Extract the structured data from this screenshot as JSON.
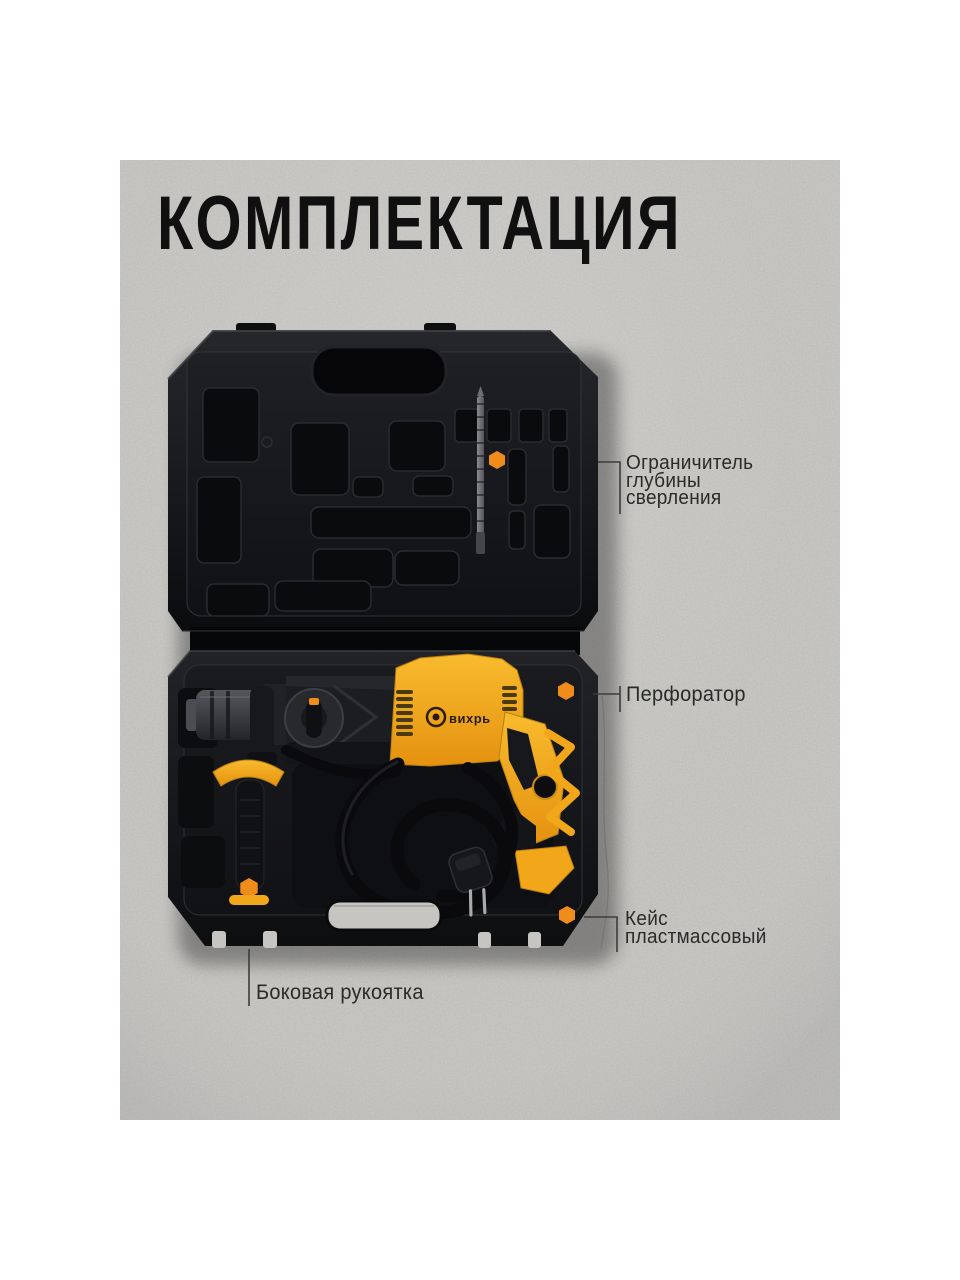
{
  "title": {
    "text": "КОМПЛЕКТАЦИЯ"
  },
  "callouts": [
    {
      "id": "depth-stop",
      "text": "Ограничитель\nглубины\nсверления"
    },
    {
      "id": "hammer",
      "text": "Перфоратор"
    },
    {
      "id": "plastic-case",
      "text": "Кейс\nпластмассовый"
    },
    {
      "id": "side-handle",
      "text": "Боковая рукоятка"
    }
  ],
  "product": {
    "brand_logo_text": "вихрь"
  },
  "colors": {
    "page_background": "#ffffff",
    "wall_gray": "#cac9c6",
    "case_black": "#121316",
    "tool_yellow": "#f2a71b",
    "accent_orange": "#ef8c1a",
    "title_text": "#101010",
    "label_text": "#2a2a2a"
  }
}
